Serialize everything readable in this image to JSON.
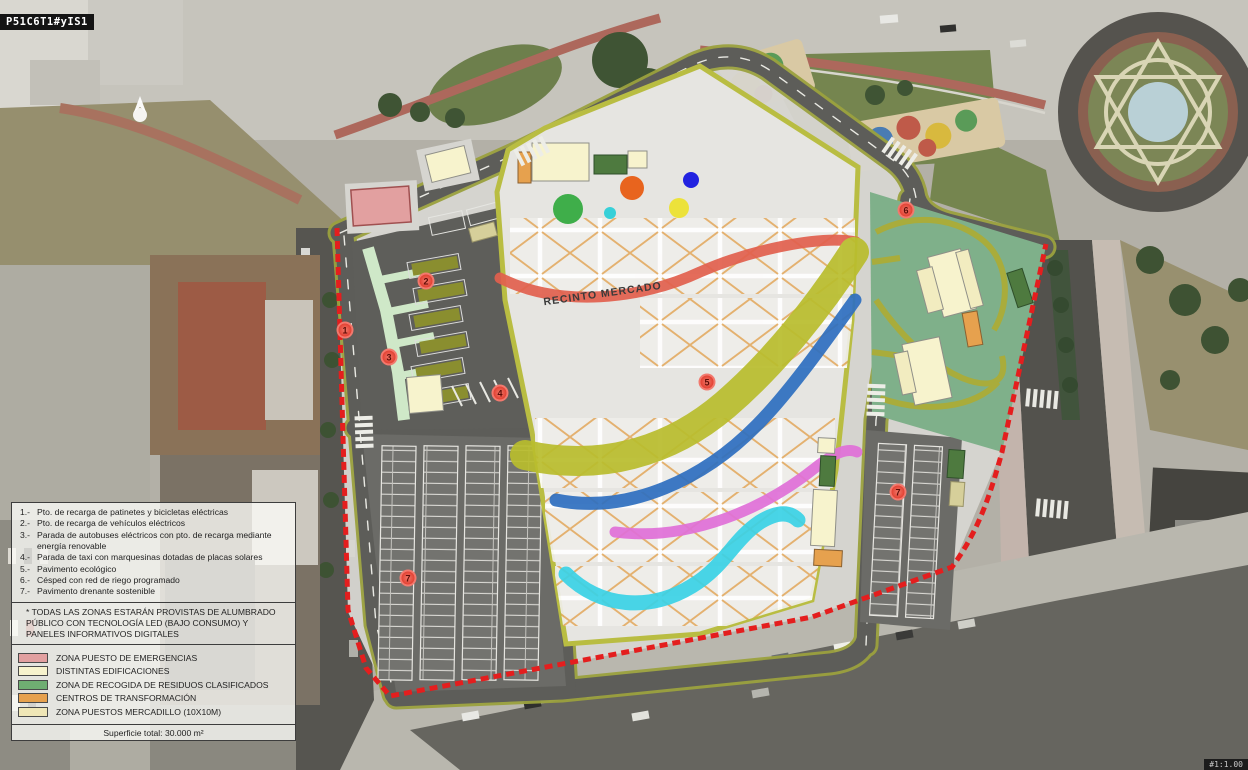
{
  "watermarks": {
    "top_left": "P51C6T1#yIS1",
    "bottom_right": "#1:1.00"
  },
  "plan": {
    "area_label": "RECINTO MERCADO",
    "markers": [
      {
        "n": "1"
      },
      {
        "n": "2"
      },
      {
        "n": "3"
      },
      {
        "n": "4"
      },
      {
        "n": "5"
      },
      {
        "n": "6"
      },
      {
        "n": "7"
      },
      {
        "n": "7"
      }
    ],
    "colors": {
      "boundary_dashed": "#e41e1e",
      "road_edge": "#9ba13e",
      "asphalt": "#5d5d59",
      "market_paving": "#e6e5e1",
      "lawn_zone": "#7fb08a",
      "ribbon_salmon": "#e2604e",
      "ribbon_olive": "#b9bd2d",
      "ribbon_blue": "#2e6fc0",
      "ribbon_magenta": "#e070d8",
      "ribbon_cyan": "#3ad2e6"
    }
  },
  "legend": {
    "numbered_items": [
      {
        "num": "1.-",
        "text": "Pto. de recarga de patinetes y bicicletas eléctricas"
      },
      {
        "num": "2.-",
        "text": "Pto. de recarga de vehículos eléctricos"
      },
      {
        "num": "3.-",
        "text": "Parada de autobuses eléctricos con pto. de recarga mediante energía renovable"
      },
      {
        "num": "4.-",
        "text": "Parada de taxi con marquesinas dotadas de placas solares"
      },
      {
        "num": "5.-",
        "text": "Pavimento ecológico"
      },
      {
        "num": "6.-",
        "text": "Césped con red de riego programado"
      },
      {
        "num": "7.-",
        "text": "Pavimento drenante sostenible"
      }
    ],
    "note": "* Todas las zonas estarán provistas de alumbrado público con tecnología LED (bajo consumo) y paneles informativos digitales",
    "color_items": [
      {
        "label": "Zona puesto de emergencias",
        "color": "#e2a0a0"
      },
      {
        "label": "Distintas edificaciones",
        "color": "#f7f3cd"
      },
      {
        "label": "Zona de recogida de residuos clasificados",
        "color": "#6fae72"
      },
      {
        "label": "Centros de transformación",
        "color": "#e6a14e"
      },
      {
        "label": "Zona puestos mercadillo (10x10m)",
        "color": "#efe6b6"
      }
    ],
    "footer": "Superficie total: 30.000 m²"
  }
}
